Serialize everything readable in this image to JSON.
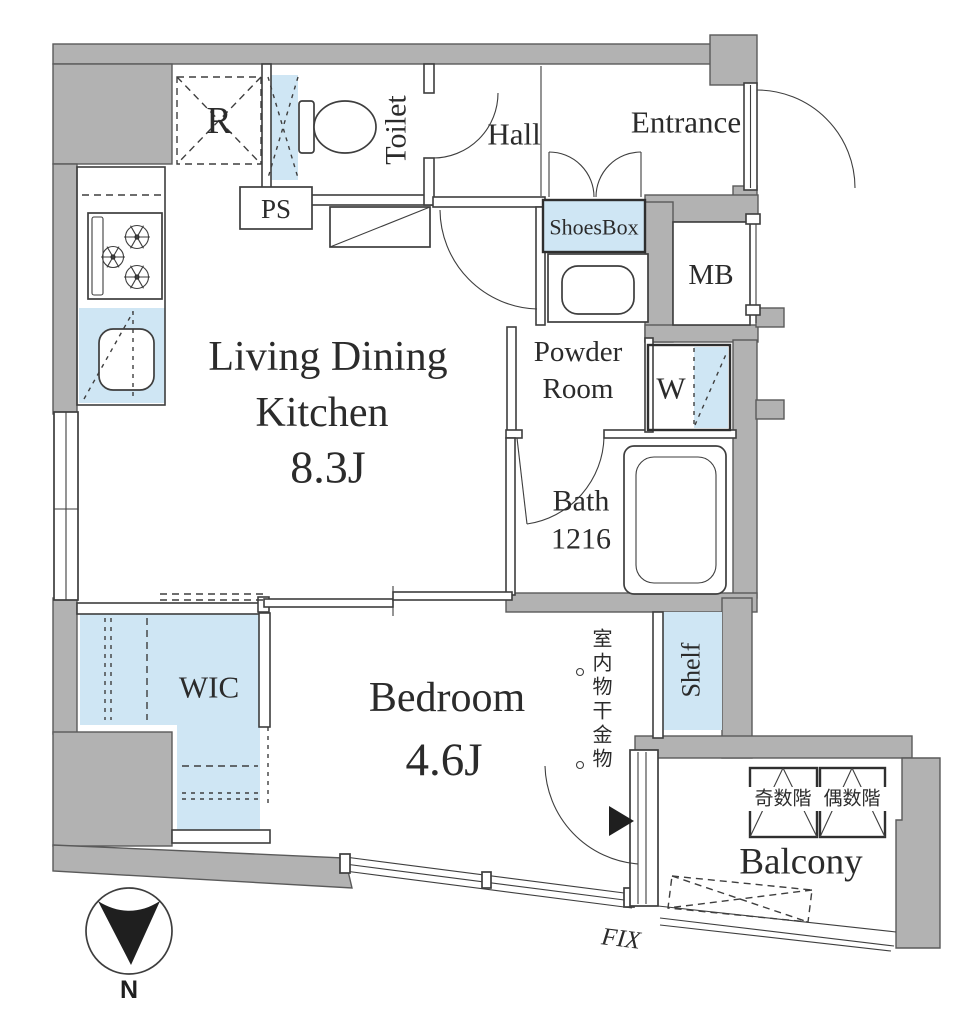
{
  "colors": {
    "wall_gray": "#b2b2b2",
    "line": "#3e3e3e",
    "accent_blue": "#cfe6f4",
    "text": "#2b2b2b"
  },
  "rooms": {
    "ldk": {
      "name_line1": "Living Dining",
      "name_line2": "Kitchen",
      "size": "8.3J"
    },
    "bedroom": {
      "name": "Bedroom",
      "size": "4.6J"
    },
    "toilet": {
      "name": "Toilet"
    },
    "hall": {
      "name": "Hall"
    },
    "entrance": {
      "name": "Entrance"
    },
    "powder_room": {
      "name_line1": "Powder",
      "name_line2": "Room"
    },
    "bath": {
      "name": "Bath",
      "size": "1216"
    },
    "wic": {
      "name": "WIC"
    },
    "balcony": {
      "name": "Balcony"
    }
  },
  "fixtures": {
    "refrigerator": "R",
    "pipe_space": "PS",
    "shoes_box": "ShoesBox",
    "meter_box": "MB",
    "washer": "W",
    "shelf": "Shelf",
    "laundry_hook": "室内物干金物",
    "hatch_odd": "奇数階",
    "hatch_even": "偶数階",
    "fix_window": "FIX"
  },
  "compass": {
    "label": "N"
  }
}
